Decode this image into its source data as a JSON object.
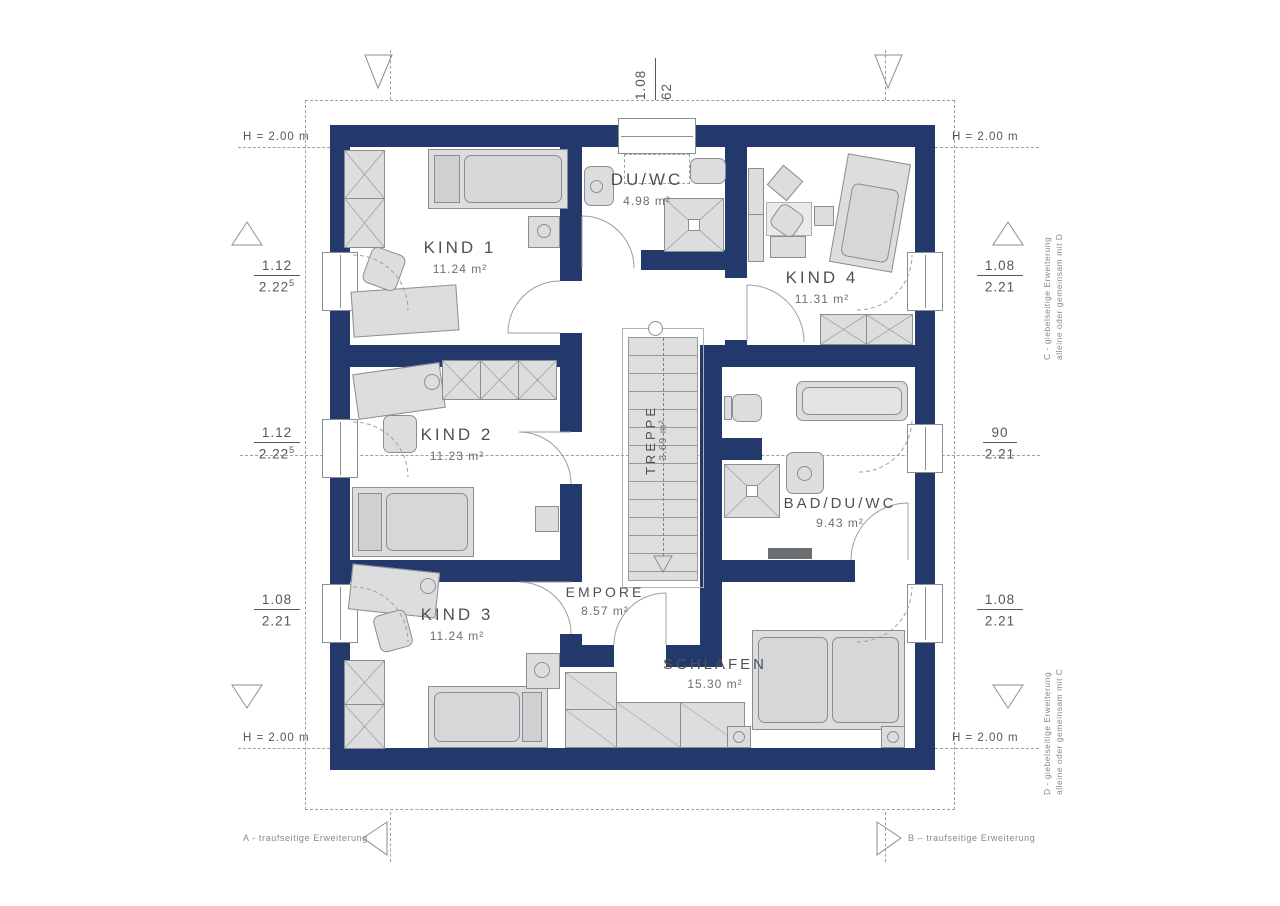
{
  "rooms": {
    "kind1": {
      "name": "KIND 1",
      "area": "11.24 m²"
    },
    "kind2": {
      "name": "KIND 2",
      "area": "11.23 m²"
    },
    "kind3": {
      "name": "KIND 3",
      "area": "11.24 m²"
    },
    "kind4": {
      "name": "KIND 4",
      "area": "11.31 m²"
    },
    "duwc": {
      "name": "DU/WC",
      "area": "4.98 m²"
    },
    "bad": {
      "name": "BAD/DU/WC",
      "area": "9.43 m²"
    },
    "schlafen": {
      "name": "SCHLAFEN",
      "area": "15.30 m²"
    },
    "empore": {
      "name": "EMPORE",
      "area": "8.57 m²"
    },
    "treppe": {
      "name": "TREPPE",
      "area": "3.69 m²"
    }
  },
  "dimensions": {
    "height_label": "H = 2.00 m",
    "top": {
      "a": "1.08",
      "b": "62"
    },
    "left": [
      {
        "a": "1.12",
        "b": "2.22",
        "sup": "5"
      },
      {
        "a": "1.12",
        "b": "2.22",
        "sup": "5"
      },
      {
        "a": "1.08",
        "b": "2.21",
        "sup": ""
      }
    ],
    "right": [
      {
        "a": "1.08",
        "b": "2.21",
        "sup": ""
      },
      {
        "a": "90",
        "b": "2.21",
        "sup": ""
      },
      {
        "a": "1.08",
        "b": "2.21",
        "sup": ""
      }
    ]
  },
  "notes": {
    "right_top_line1": "C - giebelseitige Erweiterung",
    "right_top_line2": "alleine oder gemeinsam mit D",
    "right_bottom_line1": "D - giebelseitige Erweiterung",
    "right_bottom_line2": "alleine oder gemeinsam mit C",
    "bottom_left": "A - traufseitige Erweiterung",
    "bottom_right": "B – traufseitige Erweiterung"
  },
  "colors": {
    "wall": "#24396B",
    "furniture": "#dcdddf",
    "line": "#9aa0a6"
  }
}
